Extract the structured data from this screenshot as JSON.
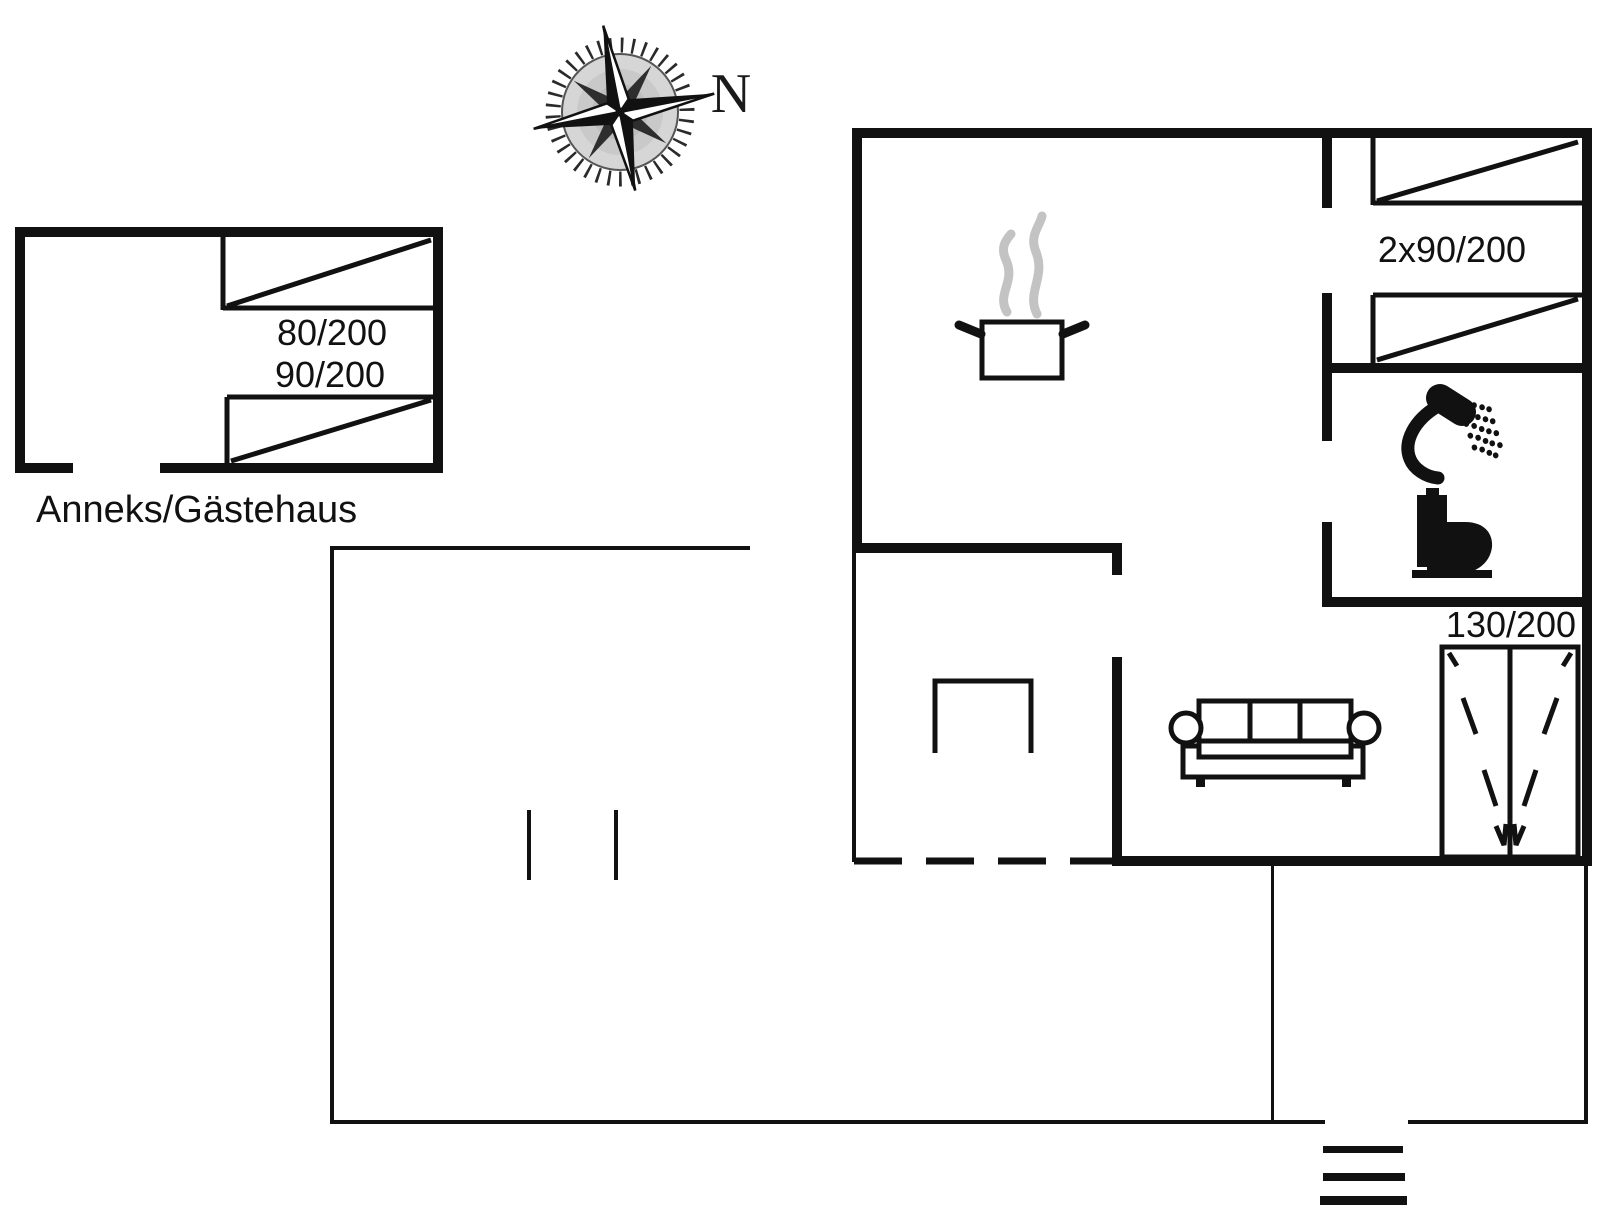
{
  "title": "Holiday home floor plan",
  "palette": {
    "line": "#111111",
    "background": "#ffffff",
    "steam_gray": "#c3c3c3"
  },
  "compass": {
    "north_label": "N"
  },
  "annex": {
    "title": "Anneks/Gästehaus",
    "bed_sizes": [
      "80/200",
      "90/200"
    ]
  },
  "main_house": {
    "bedroom": {
      "bed_size_label": "2x90/200"
    },
    "hall": {
      "wardrobe_size_label": "130/200"
    },
    "icons": [
      "steaming-pot",
      "shower",
      "toilet",
      "sofa",
      "table",
      "wardrobe",
      "entrance-steps"
    ]
  }
}
